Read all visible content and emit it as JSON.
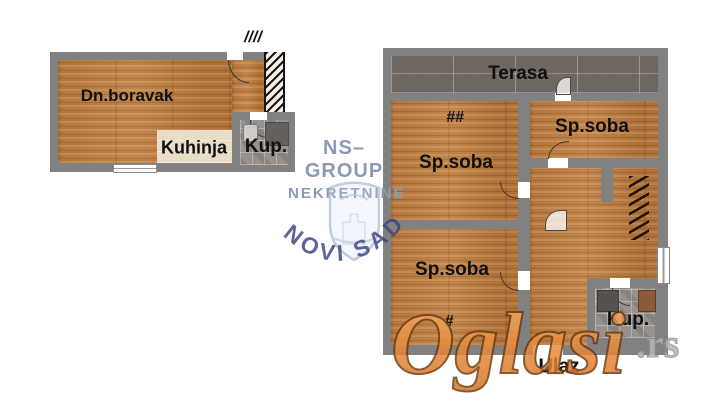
{
  "left_unit": {
    "living_room": "Dn.boravak",
    "kitchen": "Kuhinja",
    "bathroom": "Kup.",
    "stairs_mark": "////"
  },
  "right_unit": {
    "terrace": "Terasa",
    "bedroom_top_left": "Sp.soba",
    "bedroom_top_left_mark": "##",
    "bedroom_top_right": "Sp.soba",
    "bedroom_bottom": "Sp.soba",
    "bedroom_bottom_mark": "#",
    "bathroom": "Kup.",
    "entrance": "Ulaz"
  },
  "watermarks": {
    "agency_name": "NS–GROUP",
    "agency_subtitle": "NEKRETNINE",
    "agency_city": "NOVI SAD",
    "portal": "Oglasi",
    "portal_tld": ".rs"
  },
  "colors": {
    "wall_gray": "#818181",
    "wood_floor": "#b87b41",
    "kitchen_floor": "#e9ddc6",
    "bath_tile": "#98928e",
    "terrace_tile": "#6f6761",
    "portal_orange": "#e8883a",
    "agency_blue": "#8b99b5",
    "city_navy": "#3a4680"
  }
}
